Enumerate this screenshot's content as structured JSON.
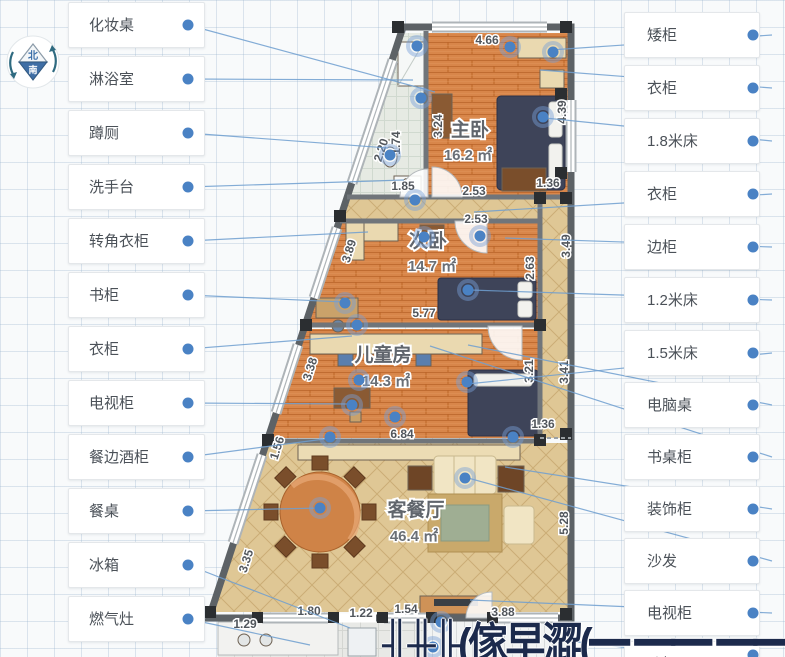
{
  "compass": {
    "north_label": "北",
    "south_label": "南"
  },
  "left_labels": [
    {
      "label": "化妆桌"
    },
    {
      "label": "淋浴室"
    },
    {
      "label": "蹲厕"
    },
    {
      "label": "洗手台"
    },
    {
      "label": "转角衣柜"
    },
    {
      "label": "书柜"
    },
    {
      "label": "衣柜"
    },
    {
      "label": "电视柜"
    },
    {
      "label": "餐边酒柜"
    },
    {
      "label": "餐桌"
    },
    {
      "label": "冰箱"
    },
    {
      "label": "燃气灶"
    }
  ],
  "right_labels": [
    {
      "label": "矮柜"
    },
    {
      "label": "衣柜"
    },
    {
      "label": "1.8米床"
    },
    {
      "label": "衣柜"
    },
    {
      "label": "边柜"
    },
    {
      "label": "1.2米床"
    },
    {
      "label": "1.5米床"
    },
    {
      "label": "电脑桌"
    },
    {
      "label": "书桌柜"
    },
    {
      "label": "装饰柜"
    },
    {
      "label": "沙发"
    },
    {
      "label": "电视柜"
    },
    {
      "label": "斗柜"
    }
  ],
  "plan": {
    "rooms": [
      {
        "name": "主卧",
        "area": "16.2 ㎡"
      },
      {
        "name": "次卧",
        "area": "14.7 ㎡"
      },
      {
        "name": "儿童房",
        "area": "14.3 ㎡"
      },
      {
        "name": "客餐厅",
        "area": "46.4 ㎡"
      }
    ],
    "dims": {
      "top": "4.66",
      "bath_v1": "2.20",
      "bath_v2": "1.74",
      "bath_r": "3.24",
      "bath_b": "1.85",
      "hall1": "2.53",
      "hall2": "2.53",
      "diag1": "3.89",
      "diag2": "3.38",
      "diag3": "1.56",
      "diag4": "3.35",
      "bed2_b": "5.77",
      "kids_b": "6.84",
      "b1": "1.29",
      "b2": "1.80",
      "b3": "1.22",
      "b4": "1.54",
      "b5": "3.88",
      "r1": "4.39",
      "r2": "1.36",
      "r3": "2.63",
      "r4": "3.49",
      "r5": "3.21",
      "r6": "3.41",
      "r7": "1.36",
      "r8": "5.28"
    }
  },
  "watermark": {
    "text": "╢╫╟(傢早澀(━ ━━ ━━ ━遭"
  },
  "colors": {
    "accent_dot": "#4a82c4",
    "line": "#6f9fd0",
    "wood": "#d8864a",
    "tile": "#dfc795",
    "wall": "#5d6266",
    "bed": "#3e4459",
    "label_text": "#4b5158"
  }
}
